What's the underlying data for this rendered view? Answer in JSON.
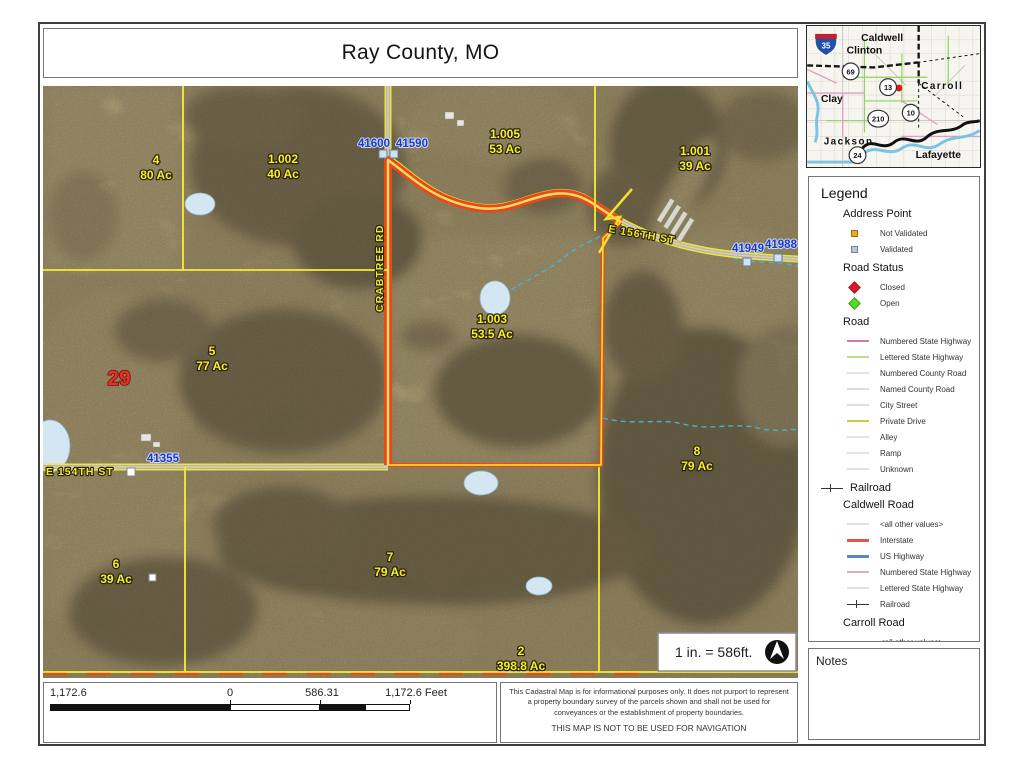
{
  "title": "Ray County, MO",
  "inset": {
    "counties": [
      "Caldwell",
      "Clinton",
      "Carroll",
      "Clay",
      "Jackson",
      "Lafayette"
    ],
    "shields": [
      "35",
      "69",
      "13",
      "210",
      "10",
      "24"
    ]
  },
  "legend": {
    "heading": "Legend",
    "sections": [
      {
        "heading": "Address Point",
        "items": [
          {
            "label": "Not Validated",
            "swatch": "square",
            "color": "#efa823"
          },
          {
            "label": "Validated",
            "swatch": "square",
            "color": "#b9c9dc"
          }
        ]
      },
      {
        "heading": "Road Status",
        "items": [
          {
            "label": "Closed",
            "swatch": "diamond",
            "color": "#e01825"
          },
          {
            "label": "Open",
            "swatch": "diamond",
            "color": "#55dd22"
          }
        ]
      },
      {
        "heading": "Road",
        "items": [
          {
            "label": "Numbered State Highway",
            "swatch": "line",
            "color": "#cb7bb4"
          },
          {
            "label": "Lettered State Highway",
            "swatch": "line",
            "color": "#c2dd88"
          },
          {
            "label": "Numbered County Road",
            "swatch": "line",
            "color": "#e3e3e3"
          },
          {
            "label": "Named County Road",
            "swatch": "line",
            "color": "#dcdcd8"
          },
          {
            "label": "City Street",
            "swatch": "line",
            "color": "#dedede"
          },
          {
            "label": "Private Drive",
            "swatch": "line",
            "color": "#d6c53e"
          },
          {
            "label": "Alley",
            "swatch": "line",
            "color": "#e4e2e2"
          },
          {
            "label": "Ramp",
            "swatch": "line",
            "color": "#eadfe3"
          },
          {
            "label": "Unknown",
            "swatch": "line",
            "color": "#e2e2e2"
          }
        ]
      },
      {
        "heading": "Railroad",
        "symbol": "rail",
        "items": []
      },
      {
        "heading": "Caldwell Road",
        "items": [
          {
            "label": "<all other values>",
            "swatch": "line",
            "color": "#e0e0e0"
          },
          {
            "label": "Interstate",
            "swatch": "line",
            "color": "#e0564a",
            "weight": 3
          },
          {
            "label": "US Highway",
            "swatch": "line",
            "color": "#5b84cb",
            "weight": 3
          },
          {
            "label": "Numbered State Highway",
            "swatch": "line",
            "color": "#e4a9bc"
          },
          {
            "label": "Lettered State Highway",
            "swatch": "line",
            "color": "#e0e4da"
          },
          {
            "label": "Railroad",
            "swatch": "rail"
          }
        ]
      },
      {
        "heading": "Carroll Road",
        "items": [
          {
            "label": "<all other values>",
            "swatch": "line",
            "color": "#e0e0e0"
          }
        ]
      }
    ]
  },
  "notes": {
    "heading": "Notes"
  },
  "scalebar": {
    "left": "1,172.6",
    "zero": "0",
    "mid": "586.31",
    "right": "1,172.6 Feet"
  },
  "disclaimer": {
    "body": "This Cadastral Map is for informational purposes only. It does not purport to represent a property boundary survey of the parcels shown and shall not be used for conveyances or the establishment of property boundaries.",
    "warning": "THIS MAP IS NOT TO BE USED FOR NAVIGATION"
  },
  "map": {
    "section_number": "29",
    "scale_note": "1 in. = 586ft.",
    "parcels": [
      {
        "id": "4",
        "acres": "80 Ac",
        "x": 113,
        "y": 78
      },
      {
        "id": "1.002",
        "acres": "40 Ac",
        "x": 240,
        "y": 77
      },
      {
        "id": "1.005",
        "acres": "53 Ac",
        "x": 462,
        "y": 52
      },
      {
        "id": "1.001",
        "acres": "39 Ac",
        "x": 652,
        "y": 69
      },
      {
        "id": "1.003",
        "acres": "53.5 Ac",
        "x": 449,
        "y": 237
      },
      {
        "id": "5",
        "acres": "77 Ac",
        "x": 169,
        "y": 269
      },
      {
        "id": "8",
        "acres": "79 Ac",
        "x": 654,
        "y": 369
      },
      {
        "id": "6",
        "acres": "39 Ac",
        "x": 73,
        "y": 482
      },
      {
        "id": "7",
        "acres": "79 Ac",
        "x": 347,
        "y": 475
      },
      {
        "id": "2",
        "acres": "398.8 Ac",
        "x": 478,
        "y": 569
      }
    ],
    "roads": [
      {
        "name": "CRABTREE RD",
        "x": 340,
        "y": 226,
        "rotate": -90
      },
      {
        "name": "E 156TH ST",
        "x": 565,
        "y": 146,
        "rotate": 10
      },
      {
        "name": "E 154TH ST",
        "x": 3,
        "y": 389,
        "rotate": 0
      }
    ],
    "addresses": [
      {
        "label": "41600",
        "x": 331,
        "y": 61
      },
      {
        "label": "41590",
        "x": 369,
        "y": 61
      },
      {
        "label": "41949",
        "x": 705,
        "y": 166
      },
      {
        "label": "41988",
        "x": 738,
        "y": 162
      },
      {
        "label": "41355",
        "x": 120,
        "y": 376
      }
    ]
  }
}
